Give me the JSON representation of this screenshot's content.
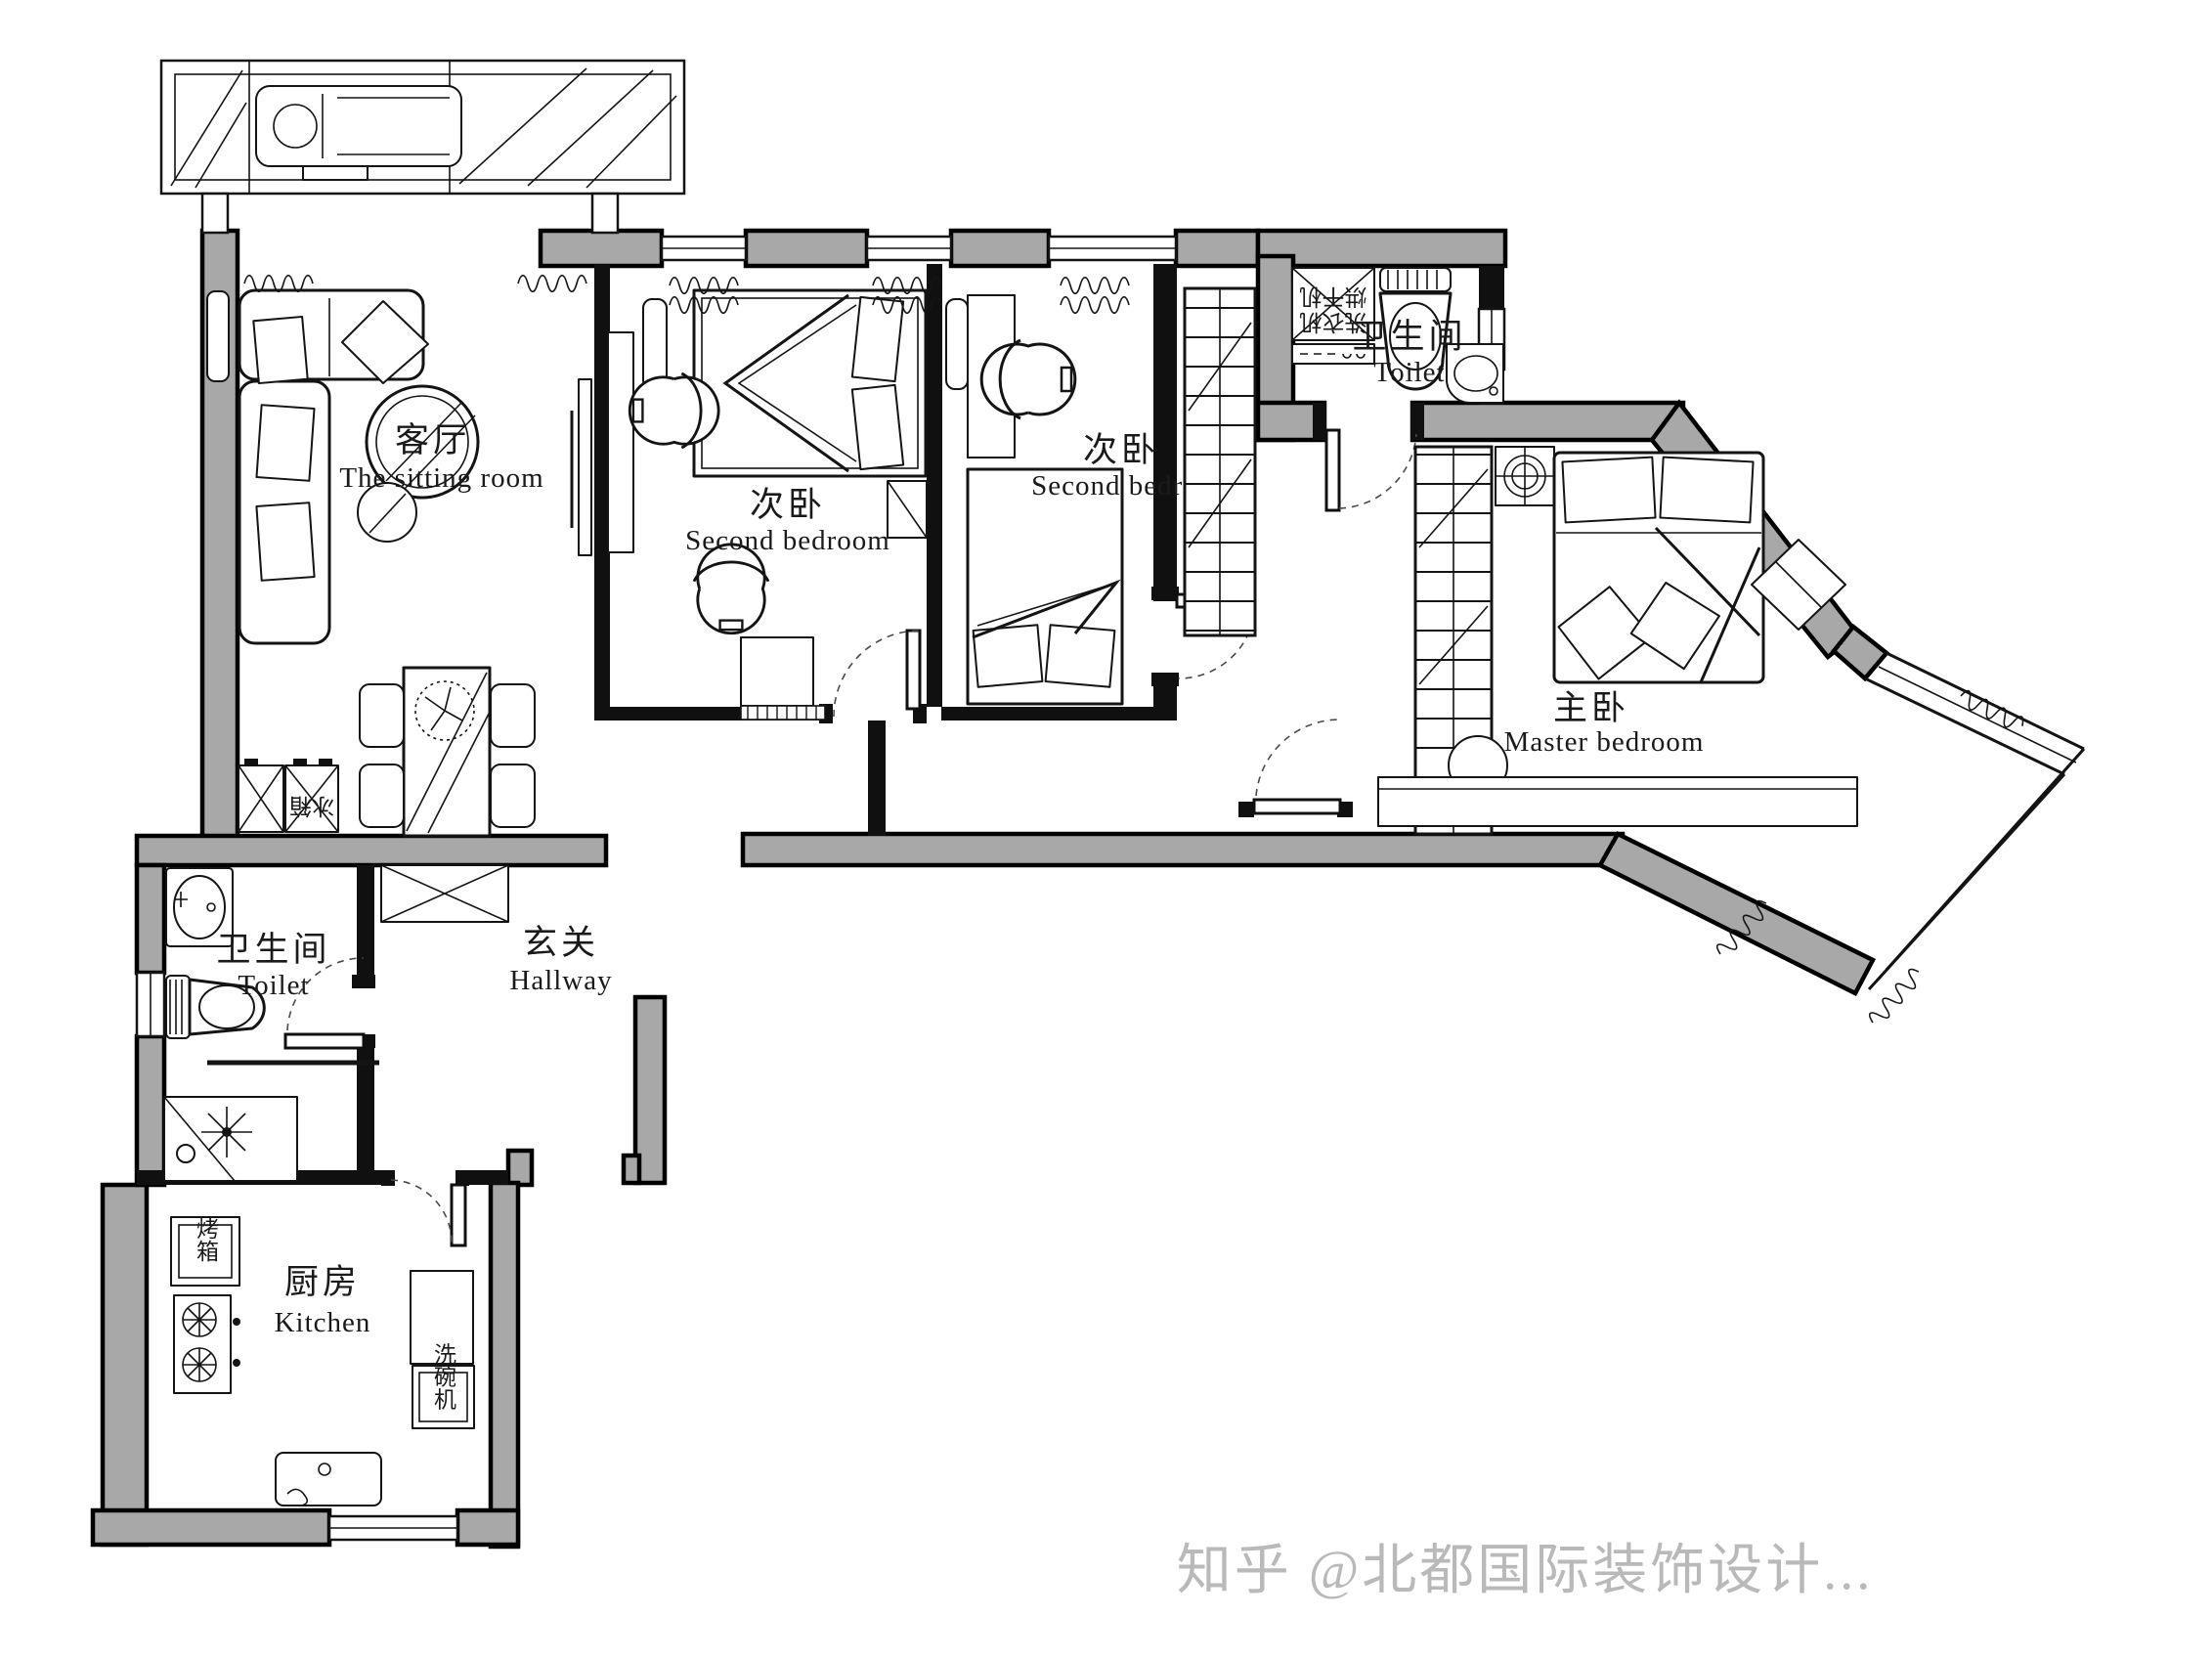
{
  "watermark": {
    "text": "知乎 @北都国际装饰设计..."
  },
  "rooms": {
    "sitting_room": {
      "zh": "客厅",
      "en": "The sitting room"
    },
    "second_bedroom_1": {
      "zh": "次卧",
      "en": "Second bedroom"
    },
    "second_bedroom_2": {
      "zh": "次卧",
      "en": "Second bedroom"
    },
    "toilet_top": {
      "zh": "卫生间",
      "en": "Toilet"
    },
    "master_bedroom": {
      "zh": "主卧",
      "en": "Master bedroom"
    },
    "toilet_lower": {
      "zh": "卫生间",
      "en": "Toilet"
    },
    "hallway": {
      "zh": "玄关",
      "en": "Hallway"
    },
    "kitchen": {
      "zh": "厨房",
      "en": "Kitchen"
    }
  },
  "appliances": {
    "oven": "烤箱",
    "dishwasher": "洗碗机",
    "fridge": "冰箱",
    "dryer": "烘干机",
    "washer": "洗衣机"
  },
  "colors": {
    "wall_fill": "#a8a8a8",
    "line": "#000000",
    "watermark_gray": "#b9b9b9",
    "background": "#ffffff"
  }
}
